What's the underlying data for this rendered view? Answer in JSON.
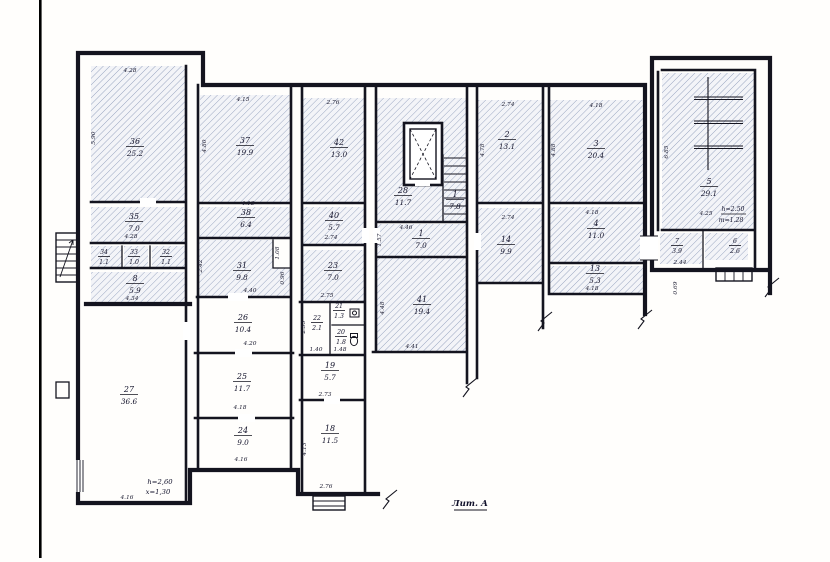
{
  "meta": {
    "litera": "Лит. А",
    "note_27_line1": "h=2,60",
    "note_27_line2": "x=1,30",
    "note_5_line1": "h=2.50",
    "note_5_line2": "т=1.28"
  },
  "colors": {
    "ink": "#14141f",
    "hatch_line": "#93a0bd",
    "hatch_bg": "#f3f4f8",
    "paper": "#fffefc"
  },
  "rooms": [
    {
      "number": "36",
      "area": "25.2",
      "hatched": true,
      "fills": [
        [
          91,
          66,
          94,
          136
        ]
      ],
      "label": [
        135,
        141
      ]
    },
    {
      "number": "35",
      "area": "7.0",
      "hatched": true,
      "fills": [
        [
          91,
          207,
          94,
          36
        ]
      ],
      "label": [
        134,
        216
      ]
    },
    {
      "number": "34",
      "area": "1.1",
      "hatched": true,
      "small": true,
      "fills": [
        [
          91,
          246,
          31,
          22
        ]
      ],
      "label": [
        104,
        251
      ]
    },
    {
      "number": "33",
      "area": "1.0",
      "hatched": true,
      "small": true,
      "fills": [
        [
          124,
          246,
          24,
          22
        ]
      ],
      "label": [
        134,
        251
      ]
    },
    {
      "number": "32",
      "area": "1.1",
      "hatched": true,
      "small": true,
      "fills": [
        [
          152,
          246,
          33,
          22
        ]
      ],
      "label": [
        166,
        251
      ]
    },
    {
      "number": "8",
      "area": "5.9",
      "hatched": true,
      "fills": [
        [
          91,
          272,
          94,
          30
        ]
      ],
      "label": [
        135,
        278
      ]
    },
    {
      "number": "37",
      "area": "19.9",
      "hatched": true,
      "fills": [
        [
          200,
          95,
          90,
          107
        ]
      ],
      "label": [
        245,
        140
      ]
    },
    {
      "number": "38",
      "area": "6.4",
      "hatched": true,
      "fills": [
        [
          200,
          207,
          91,
          31
        ]
      ],
      "label": [
        246,
        212
      ]
    },
    {
      "number": "31",
      "area": "9.8",
      "hatched": true,
      "fills": [
        [
          197,
          240,
          76,
          57
        ],
        [
          273,
          268,
          18,
          29
        ]
      ],
      "label": [
        242,
        265
      ]
    },
    {
      "number": "42",
      "area": "13.0",
      "hatched": true,
      "fills": [
        [
          303,
          98,
          62,
          105
        ]
      ],
      "label": [
        339,
        142
      ]
    },
    {
      "number": "40",
      "area": "5.7",
      "hatched": true,
      "fills": [
        [
          303,
          207,
          62,
          38
        ]
      ],
      "label": [
        334,
        215
      ]
    },
    {
      "number": "23",
      "area": "7.0",
      "hatched": true,
      "fills": [
        [
          303,
          250,
          62,
          52
        ]
      ],
      "label": [
        333,
        265
      ]
    },
    {
      "number": "28",
      "area": "11.7",
      "hatched": true,
      "fills": [
        [
          377,
          98,
          90,
          124
        ]
      ],
      "label": [
        403,
        190
      ]
    },
    {
      "number": "1",
      "area": "7.8",
      "hatched": true,
      "fills": [],
      "label": [
        455,
        194
      ]
    },
    {
      "number": "1",
      "area": "7.0",
      "hatched": true,
      "fills": [
        [
          377,
          224,
          90,
          33
        ]
      ],
      "label": [
        421,
        233
      ]
    },
    {
      "number": "41",
      "area": "19.4",
      "hatched": true,
      "fills": [
        [
          375,
          258,
          92,
          94
        ]
      ],
      "label": [
        422,
        299
      ]
    },
    {
      "number": "2",
      "area": "13.1",
      "hatched": true,
      "fills": [
        [
          478,
          100,
          65,
          103
        ]
      ],
      "label": [
        507,
        134
      ]
    },
    {
      "number": "14",
      "area": "9.9",
      "hatched": true,
      "fills": [
        [
          478,
          208,
          65,
          75
        ]
      ],
      "label": [
        506,
        239
      ]
    },
    {
      "number": "3",
      "area": "20.4",
      "hatched": true,
      "fills": [
        [
          549,
          100,
          94,
          103
        ]
      ],
      "label": [
        596,
        143
      ]
    },
    {
      "number": "4",
      "area": "11.0",
      "hatched": true,
      "fills": [
        [
          549,
          207,
          94,
          56
        ]
      ],
      "label": [
        596,
        223
      ]
    },
    {
      "number": "13",
      "area": "5.3",
      "hatched": true,
      "fills": [
        [
          549,
          266,
          94,
          28
        ]
      ],
      "label": [
        595,
        268
      ]
    },
    {
      "number": "5",
      "area": "29.1",
      "hatched": true,
      "fills": [
        [
          662,
          73,
          93,
          157
        ]
      ],
      "label": [
        709,
        181
      ]
    },
    {
      "number": "7",
      "area": "3.9",
      "hatched": true,
      "small": true,
      "fills": [
        [
          660,
          233,
          42,
          31
        ]
      ],
      "label": [
        677,
        240
      ]
    },
    {
      "number": "6",
      "area": "2.6",
      "hatched": true,
      "small": true,
      "fills": [
        [
          705,
          233,
          43,
          27
        ]
      ],
      "label": [
        735,
        240
      ]
    },
    {
      "number": "27",
      "area": "36.6",
      "hatched": false,
      "fills": [],
      "label": [
        129,
        389
      ]
    },
    {
      "number": "26",
      "area": "10.4",
      "hatched": false,
      "fills": [],
      "label": [
        243,
        317
      ]
    },
    {
      "number": "25",
      "area": "11.7",
      "hatched": false,
      "fills": [],
      "label": [
        242,
        376
      ]
    },
    {
      "number": "24",
      "area": "9.0",
      "hatched": false,
      "fills": [],
      "label": [
        243,
        430
      ]
    },
    {
      "number": "22",
      "area": "2.1",
      "hatched": false,
      "small": true,
      "fills": [],
      "label": [
        317,
        317
      ]
    },
    {
      "number": "21",
      "area": "1.3",
      "hatched": false,
      "small": true,
      "fills": [],
      "label": [
        339,
        305
      ]
    },
    {
      "number": "20",
      "area": "1.8",
      "hatched": false,
      "small": true,
      "fills": [],
      "label": [
        341,
        331
      ]
    },
    {
      "number": "19",
      "area": "5.7",
      "hatched": false,
      "fills": [],
      "label": [
        330,
        365
      ]
    },
    {
      "number": "18",
      "area": "11.5",
      "hatched": false,
      "fills": [],
      "label": [
        330,
        428
      ]
    }
  ],
  "dims": [
    {
      "t": "4.28",
      "x": 130,
      "y": 72,
      "r": 0
    },
    {
      "t": "4.15",
      "x": 243,
      "y": 101,
      "r": 0
    },
    {
      "t": "2.76",
      "x": 333,
      "y": 104,
      "r": 0
    },
    {
      "t": "2.74",
      "x": 508,
      "y": 106,
      "r": 0
    },
    {
      "t": "4.18",
      "x": 596,
      "y": 107,
      "r": 0
    },
    {
      "t": "4.28",
      "x": 131,
      "y": 238,
      "r": 0
    },
    {
      "t": "4.13",
      "x": 248,
      "y": 205,
      "r": 0
    },
    {
      "t": "4.34",
      "x": 132,
      "y": 300,
      "r": 0
    },
    {
      "t": "4.40",
      "x": 250,
      "y": 292,
      "r": 0
    },
    {
      "t": "4.20",
      "x": 250,
      "y": 345,
      "r": 0
    },
    {
      "t": "4.18",
      "x": 240,
      "y": 409,
      "r": 0
    },
    {
      "t": "4.16",
      "x": 241,
      "y": 461,
      "r": 0
    },
    {
      "t": "4.16",
      "x": 127,
      "y": 499,
      "r": 0
    },
    {
      "t": "2.74",
      "x": 331,
      "y": 239,
      "r": 0
    },
    {
      "t": "2.75",
      "x": 327,
      "y": 297,
      "r": 0
    },
    {
      "t": "1.40",
      "x": 316,
      "y": 351,
      "r": 0
    },
    {
      "t": "1.48",
      "x": 340,
      "y": 351,
      "r": 0
    },
    {
      "t": "2.73",
      "x": 325,
      "y": 396,
      "r": 0
    },
    {
      "t": "2.76",
      "x": 326,
      "y": 488,
      "r": 0
    },
    {
      "t": "4.46",
      "x": 406,
      "y": 229,
      "r": 0
    },
    {
      "t": "4.41",
      "x": 412,
      "y": 348,
      "r": 0
    },
    {
      "t": "2.74",
      "x": 508,
      "y": 219,
      "r": 0
    },
    {
      "t": "4.18",
      "x": 592,
      "y": 214,
      "r": 0
    },
    {
      "t": "4.18",
      "x": 592,
      "y": 290,
      "r": 0
    },
    {
      "t": "4.25",
      "x": 706,
      "y": 215,
      "r": 0
    },
    {
      "t": "2.44",
      "x": 680,
      "y": 264,
      "r": 0
    },
    {
      "t": "5.90",
      "x": 95,
      "y": 138,
      "r": -90
    },
    {
      "t": "4.80",
      "x": 206,
      "y": 146,
      "r": -90
    },
    {
      "t": "2.42",
      "x": 202,
      "y": 266,
      "r": -90
    },
    {
      "t": "1.08",
      "x": 279,
      "y": 253,
      "r": -90
    },
    {
      "t": "0.96",
      "x": 284,
      "y": 278,
      "r": -90
    },
    {
      "t": "4.48",
      "x": 384,
      "y": 308,
      "r": -90
    },
    {
      "t": "1.57",
      "x": 381,
      "y": 240,
      "r": -90
    },
    {
      "t": "2.53",
      "x": 305,
      "y": 327,
      "r": -90
    },
    {
      "t": "4.13",
      "x": 306,
      "y": 449,
      "r": -90
    },
    {
      "t": "4.78",
      "x": 484,
      "y": 150,
      "r": -90
    },
    {
      "t": "4.88",
      "x": 555,
      "y": 150,
      "r": -90
    },
    {
      "t": "6.85",
      "x": 668,
      "y": 152,
      "r": -90
    },
    {
      "t": "0.69",
      "x": 677,
      "y": 288,
      "r": -90
    }
  ]
}
